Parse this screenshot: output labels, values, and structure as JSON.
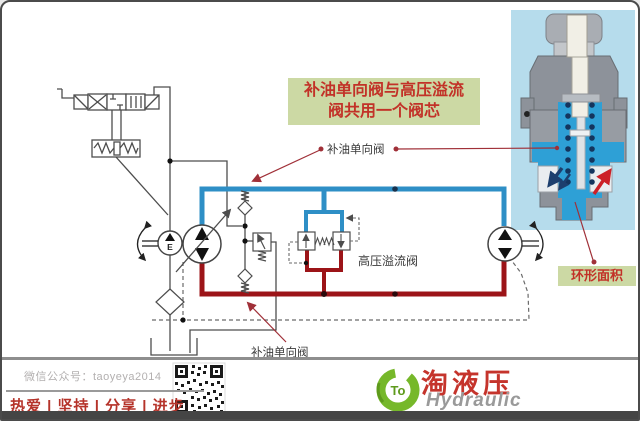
{
  "annotation_box": {
    "line1": "补油单向阀与高压溢流",
    "line2": "阀共用一个阀芯"
  },
  "labels": {
    "check_valve_top": "补油单向阀",
    "check_valve_bottom": "补油单向阀",
    "hp_relief_valve": "高压溢流阀",
    "annular_area": "环形面积",
    "charge_pump_letter": "E"
  },
  "footer": {
    "wechat_account": "微信公众号：taoyeya2014",
    "motto": "热爱 | 坚持 | 分享 | 进步",
    "brand_chinese": "淘液压",
    "brand_english": "Hydraulic",
    "logo_badge": "To"
  },
  "colors": {
    "high_pressure_line": "#9c1418",
    "low_pressure_line": "#2e8fc6",
    "label_background": "#ccd9a4",
    "label_text": "#c23228",
    "leader_line": "#a03038",
    "motto_text": "#b5332a",
    "logo_green": "#76b82a",
    "brand_red": "#c5342c",
    "cutaway_background": "#b6dcec",
    "cutaway_fluid": "#2ea0d6"
  }
}
